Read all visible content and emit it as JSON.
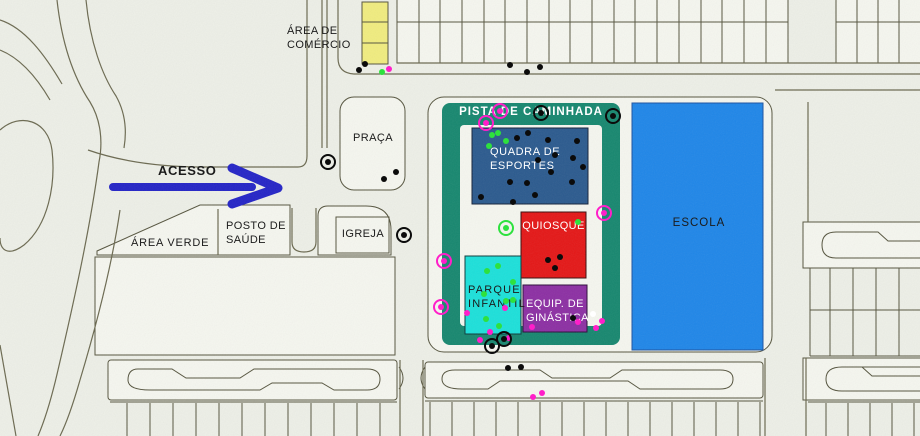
{
  "map": {
    "background": "#edefe7",
    "block_fill": "#f5f6ef",
    "line_color": "#55543e",
    "noise_opacity": 0.09
  },
  "zones": {
    "area_comercio": {
      "label": "ÁREA DE\nCOMÉRCIO",
      "building_color": "#f0ec7f"
    },
    "praca": {
      "label": "PRAÇA"
    },
    "area_verde": {
      "label": "ÁREA VERDE"
    },
    "posto_saude": {
      "label": "POSTO DE\nSAÚDE"
    },
    "igreja": {
      "label": "IGREJA"
    },
    "pista_caminhada": {
      "label": "PISTA DE CAMINHADA",
      "color": "#17876f",
      "text_color": "#ffffff"
    },
    "quadra_esportes": {
      "label": "QUADRA DE\nESPORTES",
      "color": "#2b5a8e",
      "text_color": "#ffffff"
    },
    "quiosque": {
      "label": "QUIOSQUE",
      "color": "#e41717",
      "text_color": "#ffffff"
    },
    "parque_infantil": {
      "label": "PARQUE\nINFANTIL",
      "color": "#1ce0da",
      "text_color": "#000000"
    },
    "equip_ginastica": {
      "label": "EQUIP. DE\nGINÁSTICA",
      "color": "#8c2fa3",
      "text_color": "#ffffff"
    },
    "escola": {
      "label": "ESCOLA",
      "color": "#1f86e8",
      "text_color": "#000000"
    }
  },
  "access": {
    "label": "ACESSO",
    "arrow_color": "#2424c6"
  },
  "dots": {
    "colors": {
      "black": "#0b0b0b",
      "green": "#2ee13e",
      "magenta": "#ff1fc9",
      "white": "#ffffff"
    },
    "plain": [
      {
        "x": 359,
        "y": 70,
        "c": "black"
      },
      {
        "x": 365,
        "y": 64,
        "c": "black"
      },
      {
        "x": 510,
        "y": 65,
        "c": "black"
      },
      {
        "x": 527,
        "y": 72,
        "c": "black"
      },
      {
        "x": 540,
        "y": 67,
        "c": "black"
      },
      {
        "x": 384,
        "y": 179,
        "c": "black"
      },
      {
        "x": 396,
        "y": 172,
        "c": "black"
      },
      {
        "x": 517,
        "y": 138,
        "c": "black"
      },
      {
        "x": 528,
        "y": 133,
        "c": "black"
      },
      {
        "x": 548,
        "y": 140,
        "c": "black"
      },
      {
        "x": 573,
        "y": 158,
        "c": "black"
      },
      {
        "x": 577,
        "y": 141,
        "c": "black"
      },
      {
        "x": 555,
        "y": 155,
        "c": "black"
      },
      {
        "x": 538,
        "y": 160,
        "c": "black"
      },
      {
        "x": 583,
        "y": 167,
        "c": "black"
      },
      {
        "x": 551,
        "y": 172,
        "c": "black"
      },
      {
        "x": 572,
        "y": 182,
        "c": "black"
      },
      {
        "x": 527,
        "y": 183,
        "c": "black"
      },
      {
        "x": 510,
        "y": 182,
        "c": "black"
      },
      {
        "x": 535,
        "y": 195,
        "c": "black"
      },
      {
        "x": 513,
        "y": 202,
        "c": "black"
      },
      {
        "x": 481,
        "y": 197,
        "c": "black"
      },
      {
        "x": 548,
        "y": 260,
        "c": "black"
      },
      {
        "x": 560,
        "y": 257,
        "c": "black"
      },
      {
        "x": 555,
        "y": 268,
        "c": "black"
      },
      {
        "x": 573,
        "y": 318,
        "c": "black"
      },
      {
        "x": 508,
        "y": 368,
        "c": "black"
      },
      {
        "x": 521,
        "y": 367,
        "c": "black"
      },
      {
        "x": 382,
        "y": 72,
        "c": "green"
      },
      {
        "x": 492,
        "y": 135,
        "c": "green"
      },
      {
        "x": 498,
        "y": 133,
        "c": "green"
      },
      {
        "x": 506,
        "y": 141,
        "c": "green"
      },
      {
        "x": 489,
        "y": 146,
        "c": "green"
      },
      {
        "x": 578,
        "y": 222,
        "c": "green"
      },
      {
        "x": 487,
        "y": 271,
        "c": "green"
      },
      {
        "x": 498,
        "y": 266,
        "c": "green"
      },
      {
        "x": 513,
        "y": 282,
        "c": "green"
      },
      {
        "x": 484,
        "y": 294,
        "c": "green"
      },
      {
        "x": 506,
        "y": 301,
        "c": "green"
      },
      {
        "x": 486,
        "y": 319,
        "c": "green"
      },
      {
        "x": 499,
        "y": 326,
        "c": "green"
      },
      {
        "x": 513,
        "y": 300,
        "c": "green"
      },
      {
        "x": 389,
        "y": 69,
        "c": "magenta"
      },
      {
        "x": 467,
        "y": 313,
        "c": "magenta"
      },
      {
        "x": 505,
        "y": 308,
        "c": "magenta"
      },
      {
        "x": 490,
        "y": 332,
        "c": "magenta"
      },
      {
        "x": 480,
        "y": 340,
        "c": "magenta"
      },
      {
        "x": 509,
        "y": 338,
        "c": "magenta"
      },
      {
        "x": 532,
        "y": 327,
        "c": "magenta"
      },
      {
        "x": 578,
        "y": 322,
        "c": "magenta"
      },
      {
        "x": 596,
        "y": 328,
        "c": "magenta"
      },
      {
        "x": 602,
        "y": 321,
        "c": "magenta"
      },
      {
        "x": 533,
        "y": 397,
        "c": "magenta"
      },
      {
        "x": 542,
        "y": 393,
        "c": "magenta"
      },
      {
        "x": 593,
        "y": 314,
        "c": "white"
      }
    ],
    "circled": [
      {
        "x": 328,
        "y": 162,
        "c": "black"
      },
      {
        "x": 404,
        "y": 235,
        "c": "black"
      },
      {
        "x": 541,
        "y": 113,
        "c": "black"
      },
      {
        "x": 613,
        "y": 116,
        "c": "black"
      },
      {
        "x": 492,
        "y": 346,
        "c": "black"
      },
      {
        "x": 504,
        "y": 339,
        "c": "black"
      },
      {
        "x": 500,
        "y": 111,
        "c": "magenta"
      },
      {
        "x": 486,
        "y": 123,
        "c": "magenta"
      },
      {
        "x": 604,
        "y": 213,
        "c": "magenta"
      },
      {
        "x": 444,
        "y": 261,
        "c": "magenta"
      },
      {
        "x": 441,
        "y": 307,
        "c": "magenta"
      },
      {
        "x": 506,
        "y": 228,
        "c": "green"
      }
    ]
  }
}
